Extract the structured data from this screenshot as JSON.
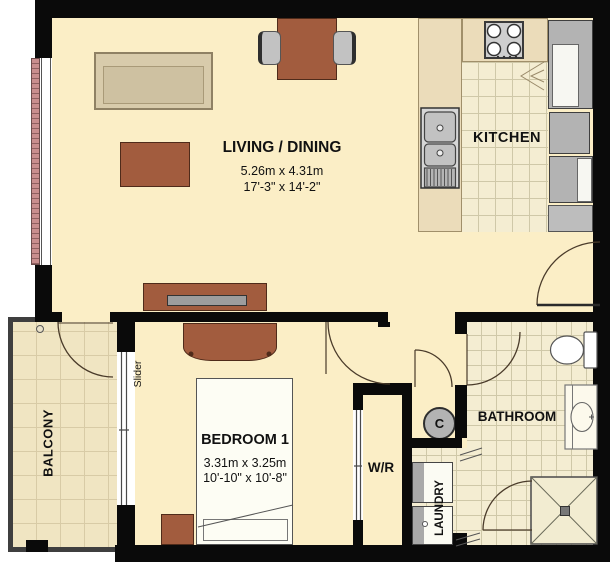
{
  "plan": {
    "rooms": {
      "living": {
        "label": "LIVING / DINING",
        "dim_metric": "5.26m x 4.31m",
        "dim_imperial": "17'-3\" x 14'-2\""
      },
      "kitchen": {
        "label": "KITCHEN"
      },
      "bedroom": {
        "label": "BEDROOM 1",
        "dim_metric": "3.31m x 3.25m",
        "dim_imperial": "10'-10\" x 10'-8\""
      },
      "bathroom": {
        "label": "BATHROOM"
      },
      "balcony": {
        "label": "BALCONY"
      },
      "closet": {
        "label": "W/R"
      },
      "laundry": {
        "label": "LAUNDRY"
      }
    },
    "annotations": {
      "slider": "Slider",
      "column": "C"
    },
    "colors": {
      "wall": "#0A0A0A",
      "floor": "#FBEEC6",
      "tile": "#F4EDD2",
      "balcony_tile": "#F0E5C2",
      "counter": "#EBDCBA",
      "wood_furniture": "#A25C3E",
      "sofa": "#D8CBAB",
      "appliance_gray": "#B3B3B3",
      "window_hatch": "#C98E8E"
    }
  }
}
